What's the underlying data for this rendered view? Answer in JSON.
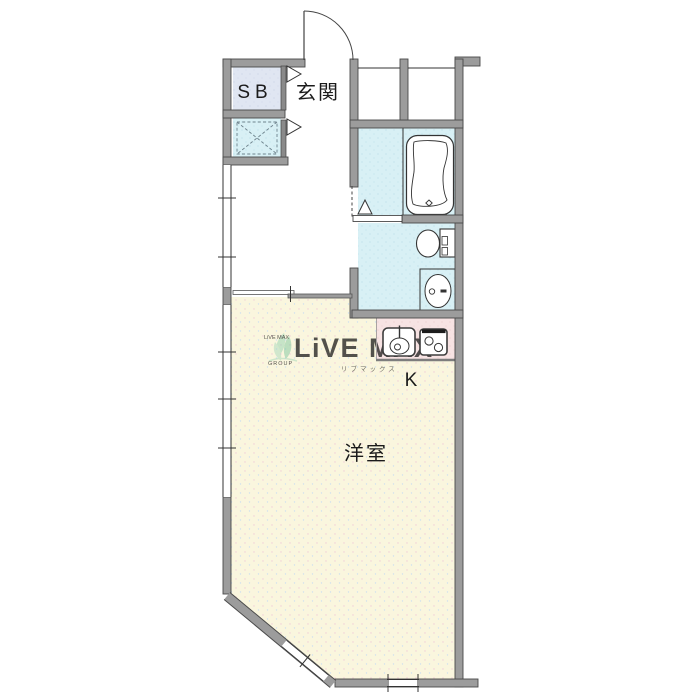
{
  "floorplan": {
    "labels": {
      "storage": "SB",
      "entrance": "玄関",
      "kitchen": "K",
      "main_room": "洋室"
    },
    "watermark": {
      "brand": "LiVE MAX",
      "brand_mini": "LiVE MAX",
      "group": "GROUP",
      "katakana": "リブマックス"
    },
    "colors": {
      "wall_gray": "#9c9c9c",
      "wet_area_cyan": "#d8f0f5",
      "main_room_cream": "#faf6de",
      "kitchen_counter_pink": "#f7e3e3",
      "storage_blue": "#e0e6f2",
      "watermark_blue": "#bdc9db",
      "watermark_green": "#8fcfae",
      "watermark_orange": "#e39b3e"
    }
  }
}
